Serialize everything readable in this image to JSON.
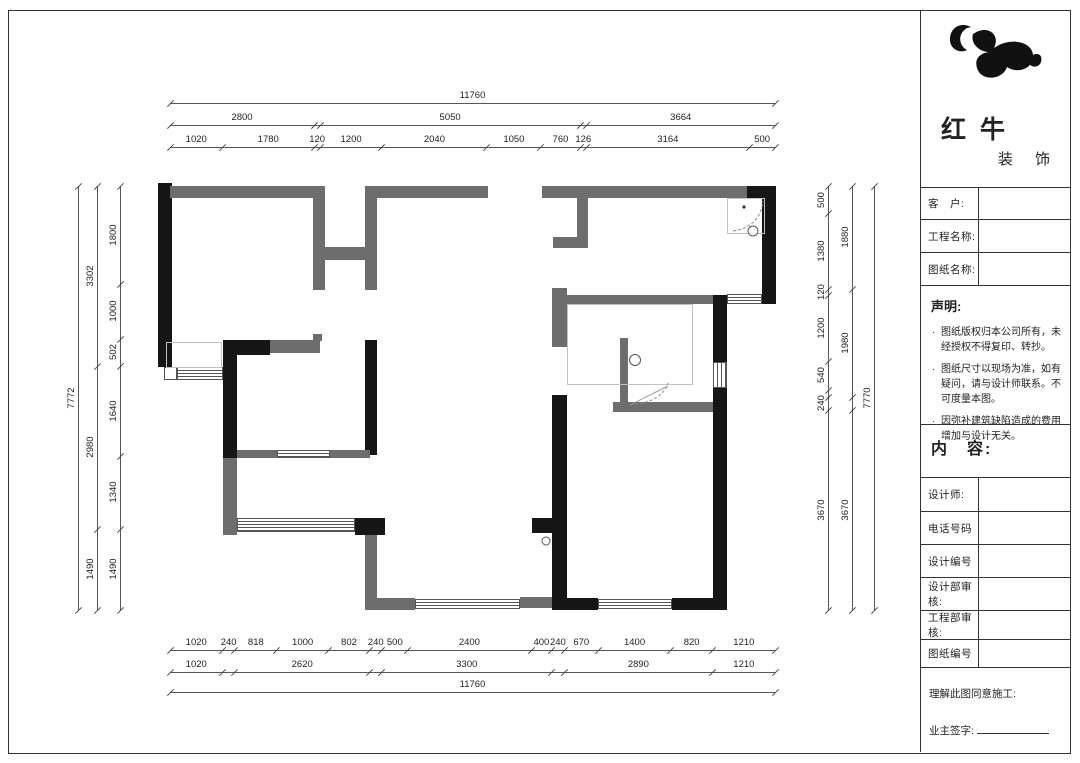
{
  "title_block": {
    "company_name": "红牛",
    "company_suffix": "装 饰",
    "fields": [
      {
        "label": "客　户:"
      },
      {
        "label": "工程名称:"
      },
      {
        "label": "图纸名称:"
      }
    ],
    "statement": {
      "title": "声明:",
      "items": [
        "图纸版权归本公司所有，未经授权不得复印、转抄。",
        "图纸尺寸以现场为准，如有疑问，请与设计师联系。不可度量本图。",
        "因弥补建筑缺陷造成的费用增加与设计无关。"
      ]
    },
    "content_label": "内　容:",
    "rows": [
      {
        "label": "设计师:"
      },
      {
        "label": "电话号码"
      },
      {
        "label": "设计编号"
      },
      {
        "label": "设计部审核:"
      },
      {
        "label": "工程部审核:"
      },
      {
        "label": "图纸编号"
      }
    ],
    "footer": {
      "agreement": "理解此图同意施工:",
      "owner_sign": "业主签字:"
    }
  },
  "colors": {
    "wall_black": "#161616",
    "wall_gray": "#6d6d6d",
    "dim_line": "#555555"
  },
  "floor_plan": {
    "units": "mm",
    "overall_width": 11760,
    "overall_height_left": 7772,
    "overall_height_right": 7770,
    "dimension_chains": [
      {
        "id": "top-overall",
        "dir": "h",
        "x": 170,
        "y": 103,
        "len": 605,
        "segments": [
          {
            "mm": 11760,
            "label": "11760"
          }
        ]
      },
      {
        "id": "top-group",
        "dir": "h",
        "x": 170,
        "y": 125,
        "len": 605,
        "segments": [
          {
            "mm": 2800,
            "label": "2800"
          },
          {
            "mm": 120,
            "label": ""
          },
          {
            "mm": 5050,
            "label": "5050"
          },
          {
            "mm": 126,
            "label": ""
          },
          {
            "mm": 3664,
            "label": "3664"
          }
        ]
      },
      {
        "id": "top-detail",
        "dir": "h",
        "x": 170,
        "y": 147,
        "len": 605,
        "segments": [
          {
            "mm": 1020,
            "label": "1020"
          },
          {
            "mm": 1780,
            "label": "1780"
          },
          {
            "mm": 120,
            "label": "120"
          },
          {
            "mm": 1200,
            "label": "1200"
          },
          {
            "mm": 2040,
            "label": "2040"
          },
          {
            "mm": 1050,
            "label": "1050"
          },
          {
            "mm": 760,
            "label": "760"
          },
          {
            "mm": 126,
            "label": "126"
          },
          {
            "mm": 3164,
            "label": "3164"
          },
          {
            "mm": 500,
            "label": "500"
          }
        ]
      },
      {
        "id": "bottom-detail",
        "dir": "h",
        "x": 170,
        "y": 650,
        "len": 605,
        "segments": [
          {
            "mm": 1020,
            "label": "1020"
          },
          {
            "mm": 240,
            "label": "240"
          },
          {
            "mm": 818,
            "label": "818"
          },
          {
            "mm": 1000,
            "label": "1000"
          },
          {
            "mm": 802,
            "label": "802"
          },
          {
            "mm": 240,
            "label": "240"
          },
          {
            "mm": 500,
            "label": "500"
          },
          {
            "mm": 2400,
            "label": "2400"
          },
          {
            "mm": 400,
            "label": "400"
          },
          {
            "mm": 240,
            "label": "240"
          },
          {
            "mm": 670,
            "label": "670"
          },
          {
            "mm": 1400,
            "label": "1400"
          },
          {
            "mm": 820,
            "label": "820"
          },
          {
            "mm": 1210,
            "label": "1210"
          }
        ]
      },
      {
        "id": "bottom-group",
        "dir": "h",
        "x": 170,
        "y": 672,
        "len": 605,
        "segments": [
          {
            "mm": 1020,
            "label": "1020"
          },
          {
            "mm": 240,
            "label": ""
          },
          {
            "mm": 2620,
            "label": "2620"
          },
          {
            "mm": 240,
            "label": ""
          },
          {
            "mm": 3300,
            "label": "3300"
          },
          {
            "mm": 240,
            "label": ""
          },
          {
            "mm": 2890,
            "label": "2890"
          },
          {
            "mm": 1210,
            "label": "1210"
          }
        ]
      },
      {
        "id": "bottom-overall",
        "dir": "h",
        "x": 170,
        "y": 692,
        "len": 605,
        "segments": [
          {
            "mm": 11760,
            "label": "11760"
          }
        ]
      },
      {
        "id": "left-overall",
        "dir": "v",
        "x": 78,
        "y": 186,
        "len": 424,
        "segments": [
          {
            "mm": 7772,
            "label": "7772"
          }
        ]
      },
      {
        "id": "left-group",
        "dir": "v",
        "x": 97,
        "y": 186,
        "len": 424,
        "segments": [
          {
            "mm": 3302,
            "label": "3302"
          },
          {
            "mm": 2980,
            "label": "2980"
          },
          {
            "mm": 1490,
            "label": "1490"
          }
        ]
      },
      {
        "id": "left-detail",
        "dir": "v",
        "x": 120,
        "y": 186,
        "len": 424,
        "segments": [
          {
            "mm": 1800,
            "label": "1800"
          },
          {
            "mm": 1000,
            "label": "1000"
          },
          {
            "mm": 502,
            "label": "502"
          },
          {
            "mm": 1640,
            "label": "1640"
          },
          {
            "mm": 1340,
            "label": "1340"
          },
          {
            "mm": 1490,
            "label": "1490"
          }
        ]
      },
      {
        "id": "right-detail",
        "dir": "v",
        "x": 828,
        "y": 186,
        "len": 424,
        "segments": [
          {
            "mm": 500,
            "label": "500"
          },
          {
            "mm": 1380,
            "label": "1380"
          },
          {
            "mm": 120,
            "label": "120"
          },
          {
            "mm": 1200,
            "label": "1200"
          },
          {
            "mm": 540,
            "label": "540"
          },
          {
            "mm": 120,
            "label": ""
          },
          {
            "mm": 240,
            "label": "240"
          },
          {
            "mm": 3670,
            "label": "3670"
          }
        ]
      },
      {
        "id": "right-group",
        "dir": "v",
        "x": 852,
        "y": 186,
        "len": 424,
        "segments": [
          {
            "mm": 1880,
            "label": "1880"
          },
          {
            "mm": 1980,
            "label": "1980"
          },
          {
            "mm": 240,
            "label": ""
          },
          {
            "mm": 3670,
            "label": "3670"
          }
        ]
      },
      {
        "id": "right-overall",
        "dir": "v",
        "x": 874,
        "y": 186,
        "len": 424,
        "segments": [
          {
            "mm": 7770,
            "label": "7770"
          }
        ]
      }
    ]
  }
}
